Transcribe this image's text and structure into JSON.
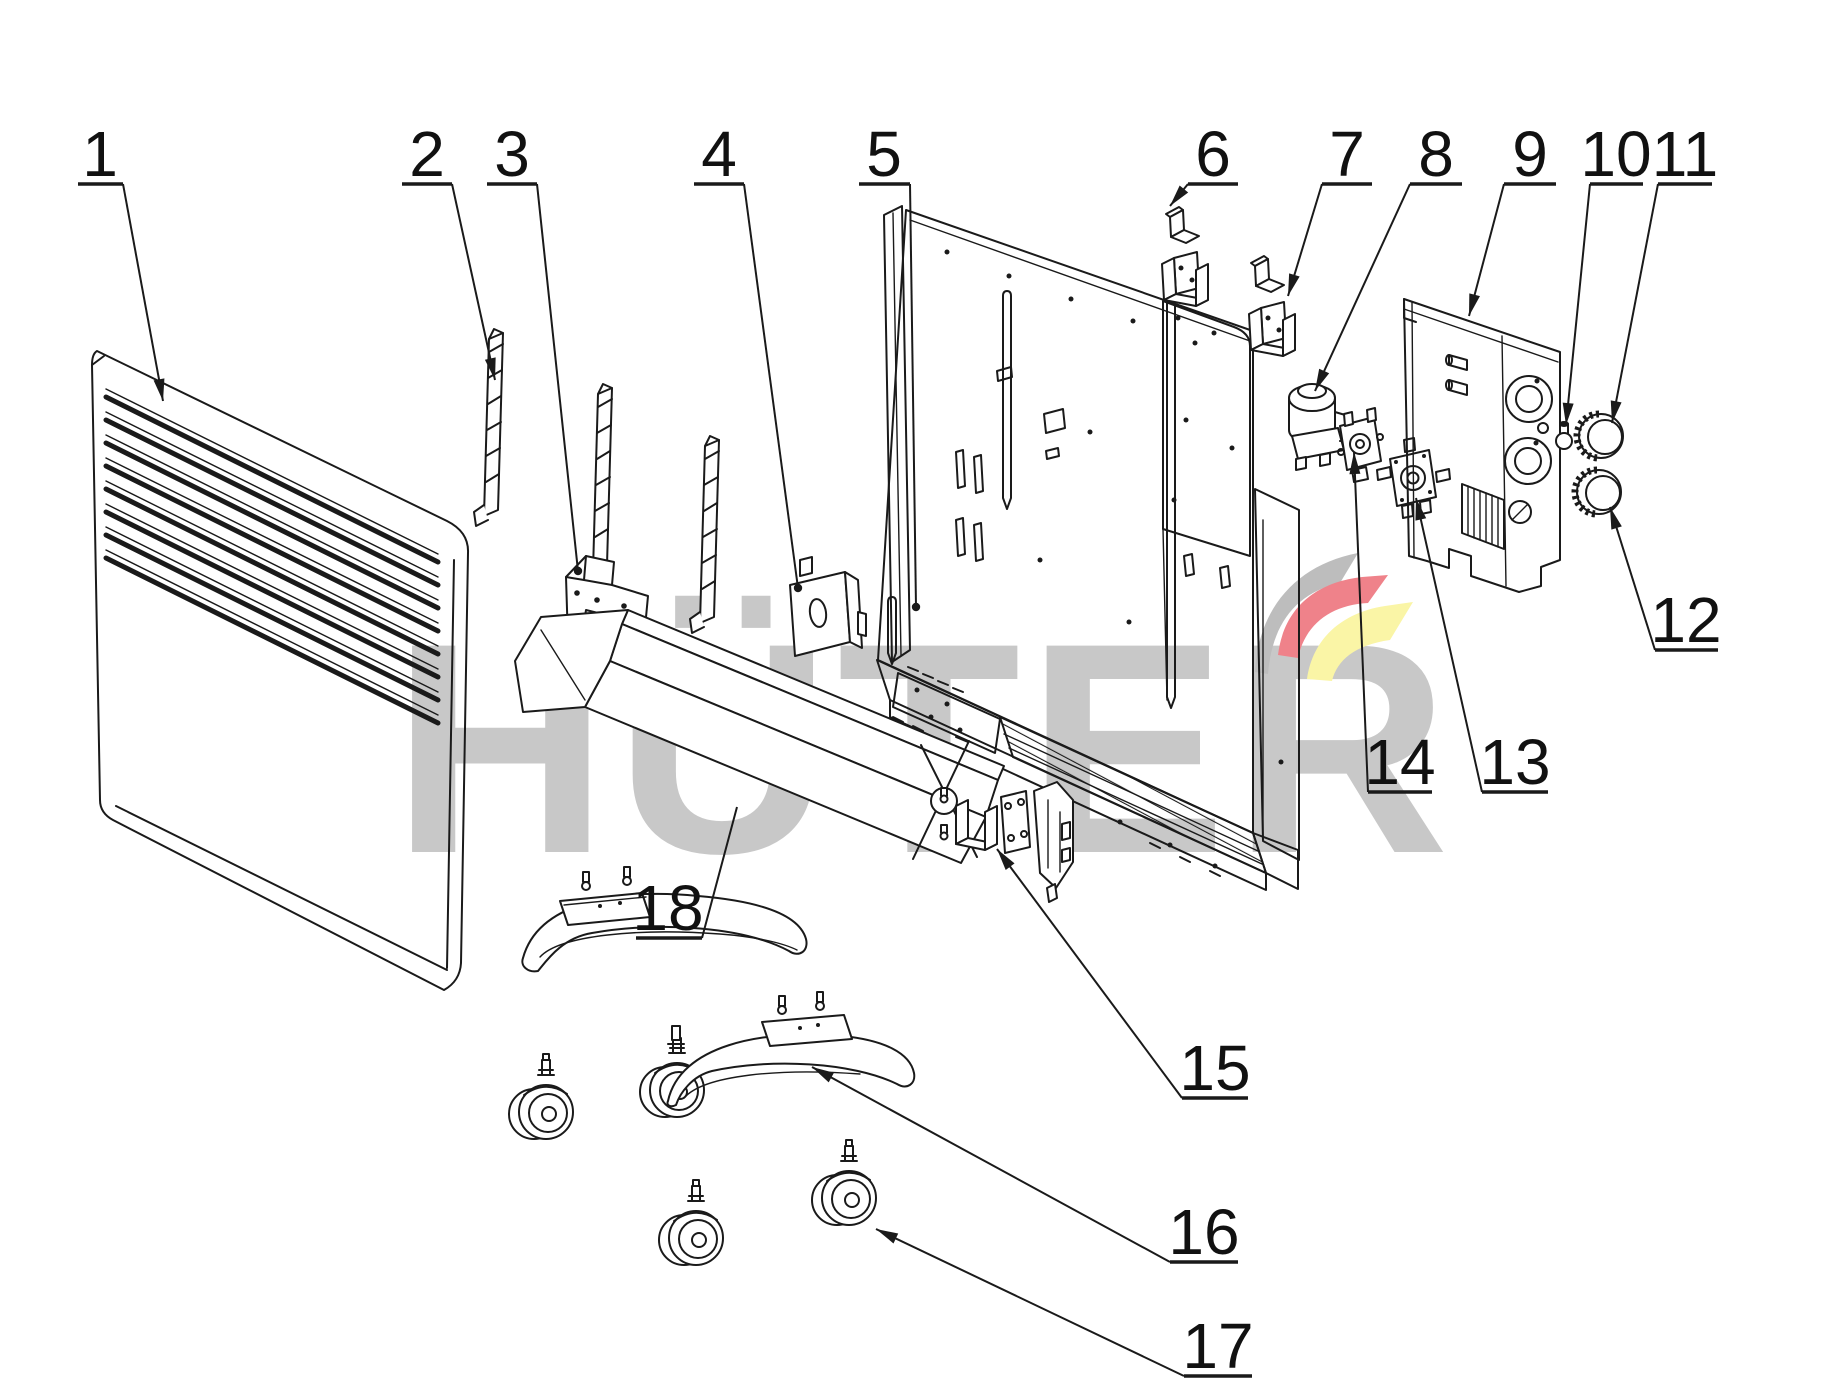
{
  "diagram": {
    "type": "exploded-parts-diagram",
    "subject": "convector heater assembly",
    "brand_watermark": "HÜTER",
    "watermark_color": "#c8c8c8",
    "logo_colors": {
      "gray": "#bdbdbd",
      "red": "#ef828a",
      "yellow": "#faf5a6"
    },
    "background_color": "#ffffff",
    "line_color": "#1a1a1a",
    "part_labels": [
      {
        "number": "1",
        "tx": 100,
        "ty": 176,
        "ux1": 78,
        "ux2": 123,
        "uy": 184,
        "sx": 123,
        "sy": 184,
        "ex": 163,
        "ey": 401,
        "end": "arrow"
      },
      {
        "number": "2",
        "tx": 427,
        "ty": 176,
        "ux1": 402,
        "ux2": 452,
        "uy": 184,
        "sx": 452,
        "sy": 184,
        "ex": 495,
        "ey": 380,
        "end": "arrow"
      },
      {
        "number": "3",
        "tx": 512,
        "ty": 176,
        "ux1": 487,
        "ux2": 537,
        "uy": 184,
        "sx": 537,
        "sy": 184,
        "ex": 578,
        "ey": 571,
        "end": "dot"
      },
      {
        "number": "4",
        "tx": 719,
        "ty": 176,
        "ux1": 694,
        "ux2": 744,
        "uy": 184,
        "sx": 744,
        "sy": 184,
        "ex": 798,
        "ey": 588,
        "end": "dot"
      },
      {
        "number": "5",
        "tx": 884,
        "ty": 176,
        "ux1": 859,
        "ux2": 910,
        "uy": 184,
        "sx": 910,
        "sy": 184,
        "ex": 916,
        "ey": 607,
        "end": "dot"
      },
      {
        "number": "6",
        "tx": 1213,
        "ty": 176,
        "ux1": 1188,
        "ux2": 1238,
        "uy": 184,
        "sx": 1188,
        "sy": 184,
        "ex": 1170,
        "ey": 206,
        "end": "arrow"
      },
      {
        "number": "7",
        "tx": 1347,
        "ty": 176,
        "ux1": 1322,
        "ux2": 1372,
        "uy": 184,
        "sx": 1322,
        "sy": 184,
        "ex": 1288,
        "ey": 296,
        "end": "arrow"
      },
      {
        "number": "8",
        "tx": 1436,
        "ty": 176,
        "ux1": 1410,
        "ux2": 1462,
        "uy": 184,
        "sx": 1410,
        "sy": 184,
        "ex": 1315,
        "ey": 391,
        "end": "arrow"
      },
      {
        "number": "9",
        "tx": 1530,
        "ty": 176,
        "ux1": 1504,
        "ux2": 1556,
        "uy": 184,
        "sx": 1504,
        "sy": 184,
        "ex": 1469,
        "ey": 316,
        "end": "arrow"
      },
      {
        "number": "10",
        "tx": 1616,
        "ty": 176,
        "ux1": 1590,
        "ux2": 1643,
        "uy": 184,
        "sx": 1590,
        "sy": 184,
        "ex": 1566,
        "ey": 425,
        "end": "arrow"
      },
      {
        "number": "11",
        "tx": 1685,
        "ty": 176,
        "ux1": 1658,
        "ux2": 1712,
        "uy": 184,
        "sx": 1658,
        "sy": 184,
        "ex": 1612,
        "ey": 423,
        "end": "arrow"
      },
      {
        "number": "12",
        "tx": 1686,
        "ty": 642,
        "ux1": 1655,
        "ux2": 1718,
        "uy": 650,
        "sx": 1655,
        "sy": 650,
        "ex": 1610,
        "ey": 507,
        "end": "arrow"
      },
      {
        "number": "13",
        "tx": 1515,
        "ty": 784,
        "ux1": 1482,
        "ux2": 1548,
        "uy": 792,
        "sx": 1482,
        "sy": 792,
        "ex": 1416,
        "ey": 498,
        "end": "arrow"
      },
      {
        "number": "14",
        "tx": 1400,
        "ty": 784,
        "ux1": 1368,
        "ux2": 1432,
        "uy": 792,
        "sx": 1368,
        "sy": 792,
        "ex": 1354,
        "ey": 452,
        "end": "arrow"
      },
      {
        "number": "15",
        "tx": 1215,
        "ty": 1090,
        "ux1": 1182,
        "ux2": 1248,
        "uy": 1098,
        "sx": 1182,
        "sy": 1098,
        "ex": 997,
        "ey": 849,
        "end": "arrow"
      },
      {
        "number": "16",
        "tx": 1204,
        "ty": 1254,
        "ux1": 1170,
        "ux2": 1238,
        "uy": 1262,
        "sx": 1170,
        "sy": 1262,
        "ex": 812,
        "ey": 1067,
        "end": "arrow"
      },
      {
        "number": "17",
        "tx": 1218,
        "ty": 1368,
        "ux1": 1184,
        "ux2": 1252,
        "uy": 1376,
        "sx": 1184,
        "sy": 1376,
        "ex": 876,
        "ey": 1229,
        "end": "arrow"
      },
      {
        "number": "18",
        "tx": 668,
        "ty": 930,
        "ux1": 636,
        "ux2": 702,
        "uy": 938,
        "sx": 702,
        "sy": 938,
        "ex": 737,
        "ey": 807,
        "end": "none"
      }
    ]
  }
}
